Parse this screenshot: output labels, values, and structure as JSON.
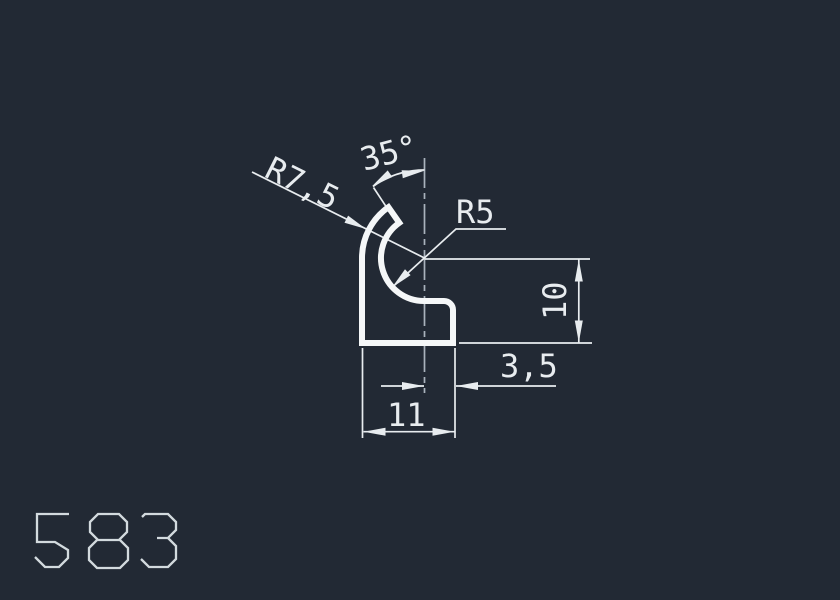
{
  "colors": {
    "background": "#222934",
    "line": "#e8ecef",
    "profile": "#f5f7f8",
    "centerline": "#a9b2bc",
    "partnum": "#d3dade"
  },
  "drawing": {
    "part_number": "583",
    "dimensions": {
      "outer_radius_label": "R7,5",
      "tip_angle_label": "35°",
      "inner_radius_label": "R5",
      "height_label": "10",
      "step_width_label": "3,5",
      "overall_width_label": "11"
    }
  }
}
